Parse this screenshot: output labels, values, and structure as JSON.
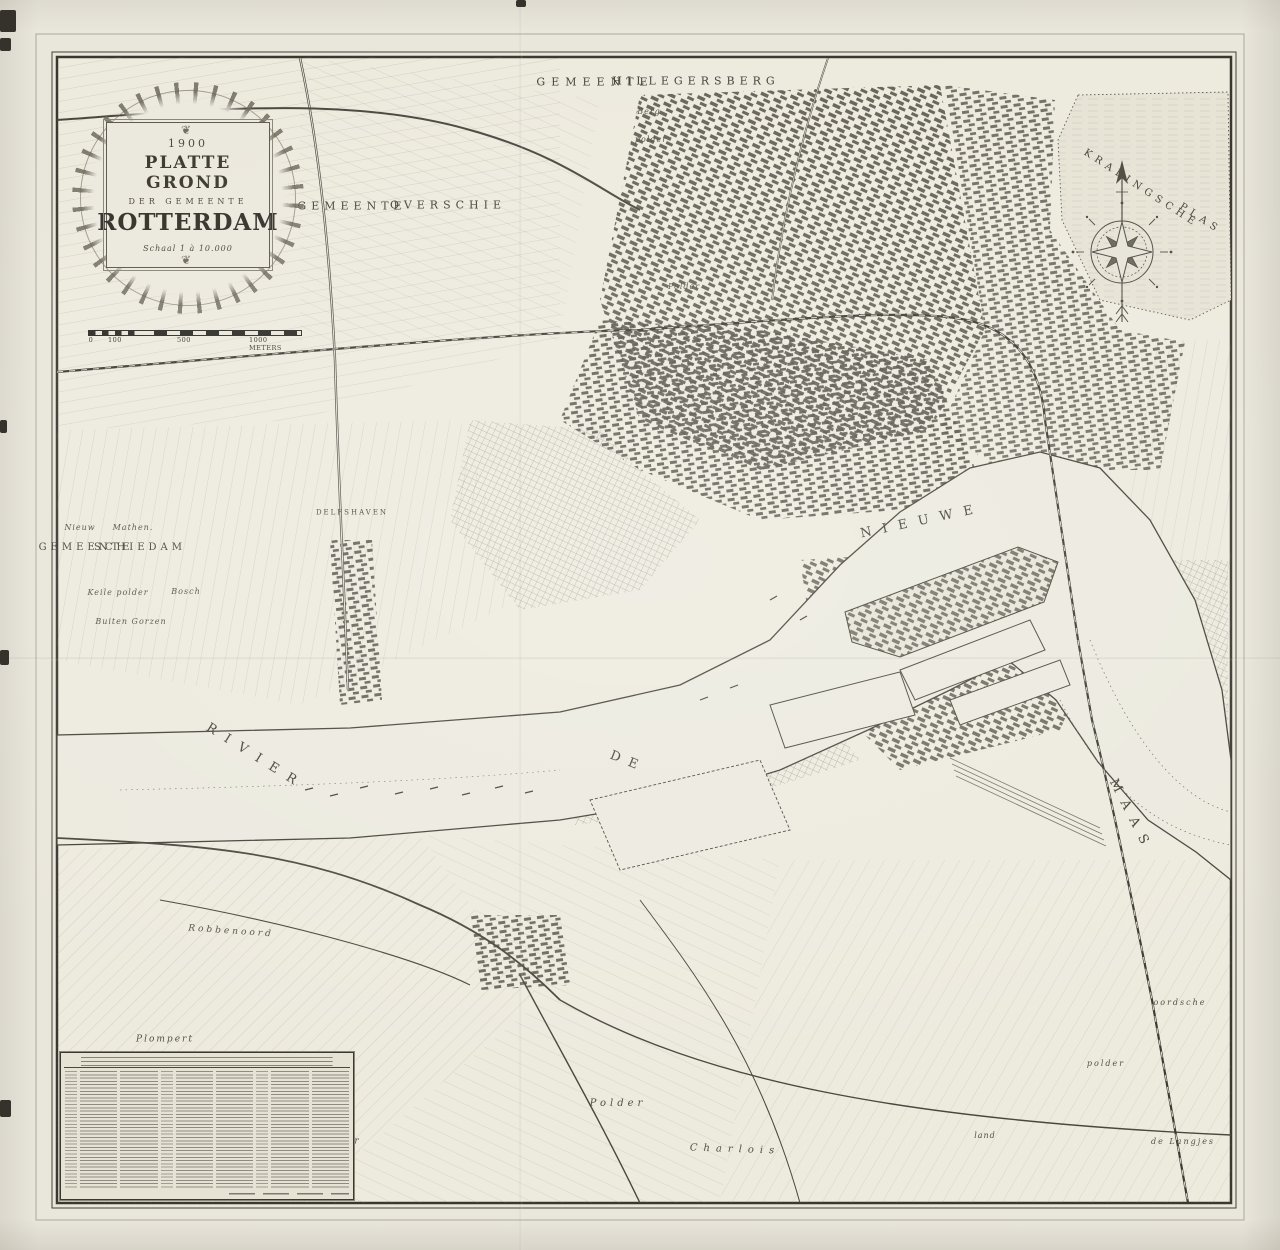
{
  "sheet": {
    "kind": "scanned antique city map",
    "city": "Rotterdam"
  },
  "cartouche": {
    "year": "1900",
    "title": "PLATTE GROND",
    "subtitle": "DER GEMEENTE",
    "city": "ROTTERDAM",
    "scale_note": "Schaal 1 à 10.000",
    "ornament_top": "❦",
    "ornament_bottom": "❦"
  },
  "scale_bar": {
    "labels": [
      "0",
      "100",
      "500",
      "1000 METERS"
    ]
  },
  "icons": {
    "compass_rose_icon": "compass-rose"
  },
  "map": {
    "labels": [
      {
        "text": "GEMEENTE",
        "x": 595,
        "y": 82,
        "size": 11,
        "ls": 6,
        "rot": 0,
        "style": "caps"
      },
      {
        "text": "HILLEGERSBERG",
        "x": 696,
        "y": 81,
        "size": 11,
        "ls": 5,
        "rot": 0,
        "style": "caps"
      },
      {
        "text": "GEMEENTE",
        "x": 352,
        "y": 206,
        "size": 11,
        "ls": 5,
        "rot": 0,
        "style": "caps"
      },
      {
        "text": "OVERSCHIE",
        "x": 448,
        "y": 205,
        "size": 11,
        "ls": 5,
        "rot": 0,
        "style": "caps"
      },
      {
        "text": "GEMEENTE",
        "x": 86,
        "y": 548,
        "size": 10,
        "ls": 4,
        "rot": 0,
        "style": "caps"
      },
      {
        "text": "SCHIEDAM",
        "x": 140,
        "y": 548,
        "size": 10,
        "ls": 4,
        "rot": 0,
        "style": "caps"
      },
      {
        "text": "DELFSHAVEN",
        "x": 352,
        "y": 513,
        "size": 7,
        "ls": 2,
        "rot": 0,
        "style": "caps"
      },
      {
        "text": "KRALINGSCHE",
        "x": 1141,
        "y": 189,
        "size": 10,
        "ls": 5,
        "rot": 33,
        "style": "caps"
      },
      {
        "text": "PLAS",
        "x": 1200,
        "y": 219,
        "size": 10,
        "ls": 5,
        "rot": 33,
        "style": "caps"
      },
      {
        "text": "RIVIER",
        "x": 256,
        "y": 757,
        "size": 13,
        "ls": 11,
        "rot": 32,
        "style": "caps"
      },
      {
        "text": "DE",
        "x": 628,
        "y": 762,
        "size": 13,
        "ls": 9,
        "rot": 22,
        "style": "caps"
      },
      {
        "text": "NIEUWE",
        "x": 922,
        "y": 521,
        "size": 13,
        "ls": 11,
        "rot": -12,
        "style": "caps"
      },
      {
        "text": "MAAS",
        "x": 1131,
        "y": 816,
        "size": 13,
        "ls": 10,
        "rot": 63,
        "style": "caps"
      },
      {
        "text": "Nieuw",
        "x": 80,
        "y": 528,
        "size": 8,
        "ls": 1,
        "rot": 0,
        "style": "it"
      },
      {
        "text": "Mathen.",
        "x": 133,
        "y": 528,
        "size": 8,
        "ls": 1,
        "rot": 0,
        "style": "it"
      },
      {
        "text": "Keile polder",
        "x": 118,
        "y": 593,
        "size": 8,
        "ls": 1,
        "rot": 0,
        "style": "it"
      },
      {
        "text": "Bosch",
        "x": 186,
        "y": 592,
        "size": 8,
        "ls": 1,
        "rot": 0,
        "style": "it"
      },
      {
        "text": "Buiten Gorzen",
        "x": 131,
        "y": 622,
        "size": 8,
        "ls": 1,
        "rot": 0,
        "style": "it"
      },
      {
        "text": "Berg",
        "x": 649,
        "y": 112,
        "size": 8,
        "ls": 1,
        "rot": 0,
        "style": "it"
      },
      {
        "text": "polder",
        "x": 651,
        "y": 140,
        "size": 8,
        "ls": 1,
        "rot": 0,
        "style": "it"
      },
      {
        "text": "Polder",
        "x": 684,
        "y": 287,
        "size": 8,
        "ls": 1,
        "rot": 0,
        "style": "it"
      },
      {
        "text": "Robbenoord",
        "x": 231,
        "y": 932,
        "size": 9,
        "ls": 3,
        "rot": 4,
        "style": "it"
      },
      {
        "text": "Plompert",
        "x": 165,
        "y": 1040,
        "size": 9,
        "ls": 2,
        "rot": 0,
        "style": "it"
      },
      {
        "text": "Robbenoord",
        "x": 270,
        "y": 1086,
        "size": 9,
        "ls": 3,
        "rot": 3,
        "style": "it"
      },
      {
        "text": "Polder",
        "x": 618,
        "y": 1104,
        "size": 10,
        "ls": 4,
        "rot": 0,
        "style": "it"
      },
      {
        "text": "polder",
        "x": 340,
        "y": 1142,
        "size": 9,
        "ls": 2,
        "rot": 0,
        "style": "it"
      },
      {
        "text": "Charlois",
        "x": 735,
        "y": 1150,
        "size": 10,
        "ls": 6,
        "rot": 2,
        "style": "it"
      },
      {
        "text": "oordsche",
        "x": 1180,
        "y": 1003,
        "size": 8,
        "ls": 2,
        "rot": 0,
        "style": "it"
      },
      {
        "text": "polder",
        "x": 1106,
        "y": 1064,
        "size": 8,
        "ls": 2,
        "rot": 0,
        "style": "it"
      },
      {
        "text": "land",
        "x": 985,
        "y": 1136,
        "size": 8,
        "ls": 1,
        "rot": 0,
        "style": "it"
      },
      {
        "text": "de Langjes",
        "x": 1183,
        "y": 1142,
        "size": 8,
        "ls": 2,
        "rot": 0,
        "style": "it"
      }
    ]
  }
}
